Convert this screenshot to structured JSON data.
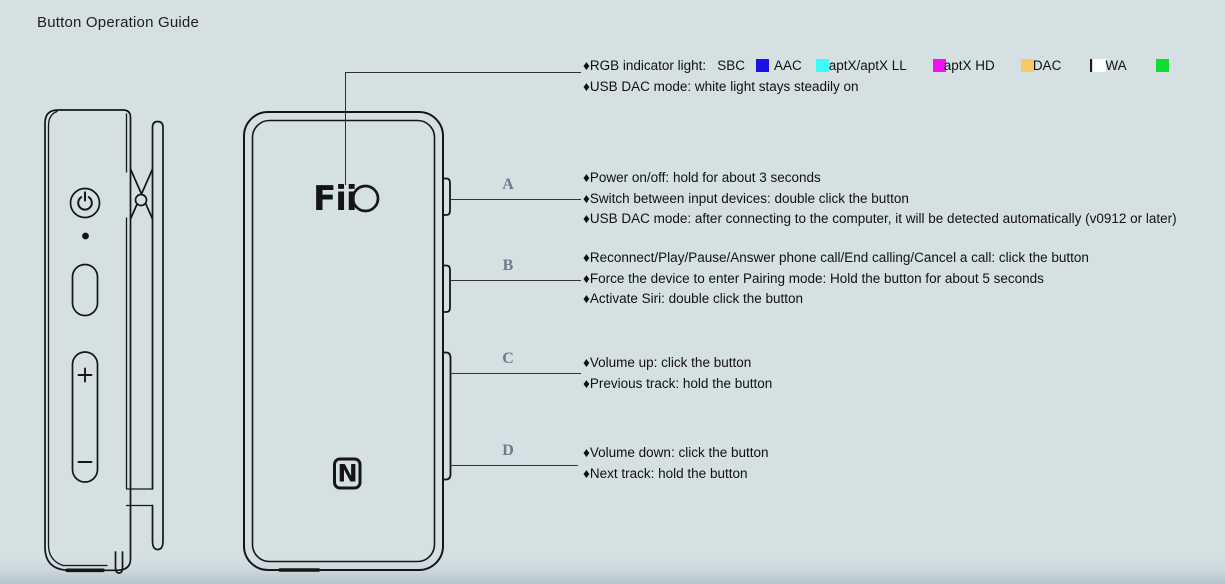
{
  "page": {
    "title": "Button Operation Guide",
    "background": "#d5e0e2"
  },
  "legend": {
    "heading": "♦RGB indicator light:",
    "first_codec": "SBC",
    "codecs": [
      {
        "name": "AAC",
        "swatch_color": "#1b12e8",
        "swatch_name": "blue"
      },
      {
        "name": "aptX/aptX LL",
        "swatch_color": "#3bfbfb",
        "swatch_name": "cyan"
      },
      {
        "name": "aptX HD",
        "swatch_color": "#f012f0",
        "swatch_name": "magenta"
      },
      {
        "name": "DAC",
        "swatch_color": "#f6c963",
        "swatch_name": "yellow"
      },
      {
        "name": "WA",
        "swatch_color": "#ffffff",
        "swatch_name": "white"
      },
      {
        "name": "",
        "swatch_color": "#0edd2e",
        "swatch_name": "green"
      }
    ],
    "line2": "♦USB DAC mode: white light stays steadily on"
  },
  "sections": [
    {
      "label": "A",
      "lines": [
        "♦Power on/off: hold for about 3 seconds",
        "♦Switch between input devices: double click the button",
        "♦USB DAC mode: after connecting to the computer, it will be detected automatically (v0912 or later)"
      ]
    },
    {
      "label": "B",
      "lines": [
        "♦Reconnect/Play/Pause/Answer phone call/End calling/Cancel a call: click the button",
        "♦Force the device to enter Pairing mode: Hold the button for about 5 seconds",
        "♦Activate Siri: double click the button"
      ]
    },
    {
      "label": "C",
      "lines": [
        "♦Volume up: click the button",
        "♦Previous track: hold the button"
      ]
    },
    {
      "label": "D",
      "lines": [
        "♦Volume down: click the button",
        "♦Next track: hold the button"
      ]
    }
  ],
  "device_front": {
    "logo_text": "Fii",
    "nfc_label": "N"
  },
  "device_side": {
    "volume_plus": "+",
    "volume_minus": "−"
  }
}
